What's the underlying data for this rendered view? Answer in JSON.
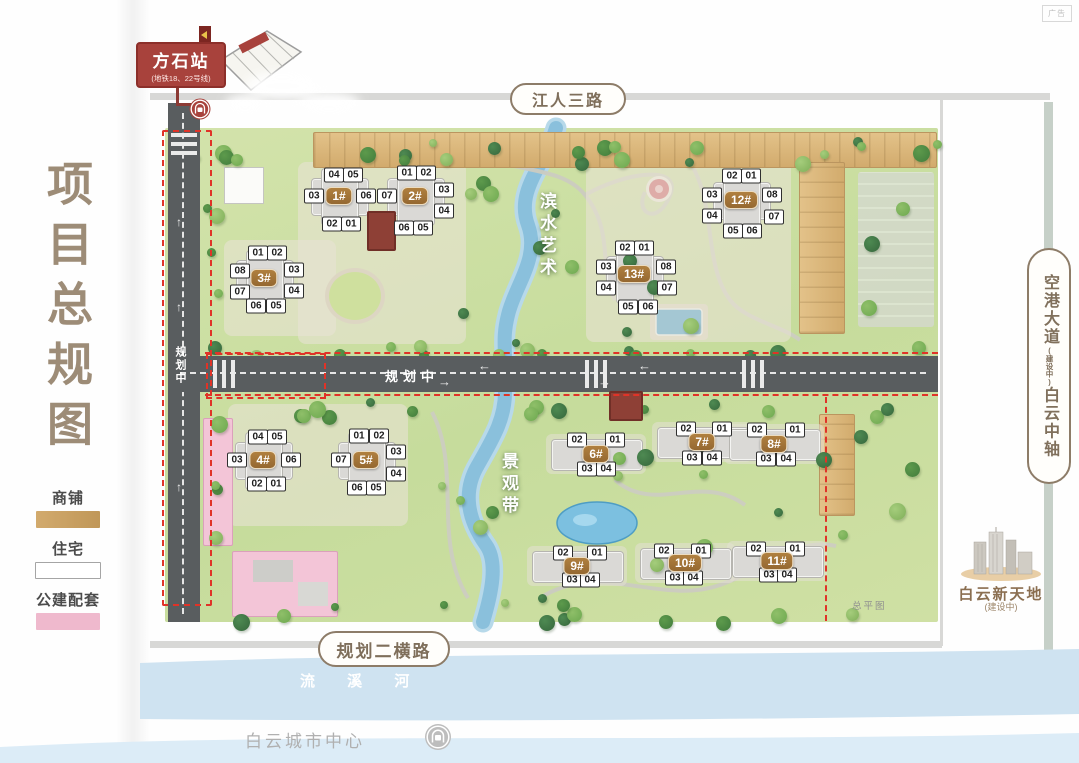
{
  "page": {
    "ad_badge": "广告",
    "plan_note": "总平图"
  },
  "title": {
    "text": "项目总规图"
  },
  "legend": [
    {
      "label": "商铺",
      "swatch": "#d2aa6d",
      "swatch2": "#c09758"
    },
    {
      "label": "住宅",
      "swatch": "#ffffff"
    },
    {
      "label": "公建配套",
      "swatch": "#efb9cd"
    }
  ],
  "station": {
    "name": "方石站",
    "lines": "(地铁18、22号线)"
  },
  "roads": {
    "top": "江人三路",
    "bottom": "规划二横路",
    "center": "规划中",
    "left": "规划中",
    "right_main": "空港大道",
    "right_sub": "(建设中)",
    "right_main2": "白云中轴",
    "arrows": {
      "left": "←",
      "right": "→",
      "up": "↑"
    }
  },
  "water": {
    "river": "流 溪 河",
    "stream_top": "滨水艺术",
    "stream_bottom": "景观带"
  },
  "landmarks": {
    "city_center": "白云城市中心",
    "new_world": "白云新天地",
    "new_world_sub": "(建设中)"
  },
  "clusters": [
    {
      "id": "1#",
      "x": 339,
      "y": 196,
      "shape": "tower",
      "units": [
        {
          "n": "04",
          "x": 334,
          "y": 175
        },
        {
          "n": "05",
          "x": 353,
          "y": 175
        },
        {
          "n": "03",
          "x": 314,
          "y": 196
        },
        {
          "n": "06",
          "x": 366,
          "y": 196
        },
        {
          "n": "07",
          "x": 387,
          "y": 196
        },
        {
          "n": "02",
          "x": 332,
          "y": 224
        },
        {
          "n": "01",
          "x": 351,
          "y": 224
        }
      ]
    },
    {
      "id": "2#",
      "x": 415,
      "y": 196,
      "shape": "tower",
      "units": [
        {
          "n": "01",
          "x": 407,
          "y": 173
        },
        {
          "n": "02",
          "x": 426,
          "y": 173
        },
        {
          "n": "03",
          "x": 444,
          "y": 190
        },
        {
          "n": "04",
          "x": 444,
          "y": 211
        },
        {
          "n": "06",
          "x": 404,
          "y": 228
        },
        {
          "n": "05",
          "x": 423,
          "y": 228
        }
      ]
    },
    {
      "id": "3#",
      "x": 264,
      "y": 278,
      "shape": "tower",
      "units": [
        {
          "n": "01",
          "x": 258,
          "y": 253
        },
        {
          "n": "02",
          "x": 277,
          "y": 253
        },
        {
          "n": "08",
          "x": 240,
          "y": 271
        },
        {
          "n": "07",
          "x": 240,
          "y": 292
        },
        {
          "n": "03",
          "x": 294,
          "y": 270
        },
        {
          "n": "04",
          "x": 294,
          "y": 291
        },
        {
          "n": "06",
          "x": 256,
          "y": 306
        },
        {
          "n": "05",
          "x": 276,
          "y": 306
        }
      ]
    },
    {
      "id": "13#",
      "x": 634,
      "y": 274,
      "shape": "tower",
      "units": [
        {
          "n": "02",
          "x": 625,
          "y": 248
        },
        {
          "n": "01",
          "x": 644,
          "y": 248
        },
        {
          "n": "03",
          "x": 606,
          "y": 267
        },
        {
          "n": "04",
          "x": 606,
          "y": 288
        },
        {
          "n": "08",
          "x": 666,
          "y": 267
        },
        {
          "n": "07",
          "x": 667,
          "y": 288
        },
        {
          "n": "05",
          "x": 628,
          "y": 307
        },
        {
          "n": "06",
          "x": 648,
          "y": 307
        }
      ]
    },
    {
      "id": "12#",
      "x": 741,
      "y": 200,
      "shape": "tower",
      "units": [
        {
          "n": "02",
          "x": 732,
          "y": 176
        },
        {
          "n": "01",
          "x": 751,
          "y": 176
        },
        {
          "n": "03",
          "x": 712,
          "y": 195
        },
        {
          "n": "04",
          "x": 712,
          "y": 216
        },
        {
          "n": "08",
          "x": 772,
          "y": 195
        },
        {
          "n": "07",
          "x": 774,
          "y": 217
        },
        {
          "n": "05",
          "x": 733,
          "y": 231
        },
        {
          "n": "06",
          "x": 752,
          "y": 231
        }
      ]
    },
    {
      "id": "4#",
      "x": 263,
      "y": 460,
      "shape": "tower",
      "units": [
        {
          "n": "04",
          "x": 258,
          "y": 437
        },
        {
          "n": "05",
          "x": 277,
          "y": 437
        },
        {
          "n": "03",
          "x": 237,
          "y": 460
        },
        {
          "n": "06",
          "x": 291,
          "y": 460
        },
        {
          "n": "02",
          "x": 257,
          "y": 484
        },
        {
          "n": "01",
          "x": 276,
          "y": 484
        }
      ]
    },
    {
      "id": "5#",
      "x": 366,
      "y": 460,
      "shape": "tower",
      "units": [
        {
          "n": "01",
          "x": 359,
          "y": 436
        },
        {
          "n": "02",
          "x": 379,
          "y": 436
        },
        {
          "n": "07",
          "x": 341,
          "y": 460
        },
        {
          "n": "03",
          "x": 396,
          "y": 452
        },
        {
          "n": "04",
          "x": 396,
          "y": 474
        },
        {
          "n": "06",
          "x": 357,
          "y": 488
        },
        {
          "n": "05",
          "x": 376,
          "y": 488
        }
      ]
    },
    {
      "id": "6#",
      "x": 596,
      "y": 454,
      "shape": "slab",
      "units": [
        {
          "n": "02",
          "x": 577,
          "y": 440
        },
        {
          "n": "01",
          "x": 615,
          "y": 440
        },
        {
          "n": "03",
          "x": 587,
          "y": 469
        },
        {
          "n": "04",
          "x": 606,
          "y": 469
        }
      ]
    },
    {
      "id": "7#",
      "x": 702,
      "y": 442,
      "shape": "slab",
      "units": [
        {
          "n": "02",
          "x": 686,
          "y": 429
        },
        {
          "n": "01",
          "x": 722,
          "y": 429
        },
        {
          "n": "03",
          "x": 692,
          "y": 458
        },
        {
          "n": "04",
          "x": 712,
          "y": 458
        }
      ]
    },
    {
      "id": "8#",
      "x": 774,
      "y": 444,
      "shape": "slab",
      "units": [
        {
          "n": "02",
          "x": 757,
          "y": 430
        },
        {
          "n": "01",
          "x": 795,
          "y": 430
        },
        {
          "n": "03",
          "x": 766,
          "y": 459
        },
        {
          "n": "04",
          "x": 786,
          "y": 459
        }
      ]
    },
    {
      "id": "9#",
      "x": 577,
      "y": 566,
      "shape": "slab",
      "units": [
        {
          "n": "02",
          "x": 563,
          "y": 553
        },
        {
          "n": "01",
          "x": 597,
          "y": 553
        },
        {
          "n": "03",
          "x": 572,
          "y": 580
        },
        {
          "n": "04",
          "x": 590,
          "y": 580
        }
      ]
    },
    {
      "id": "10#",
      "x": 685,
      "y": 563,
      "shape": "slab",
      "units": [
        {
          "n": "02",
          "x": 664,
          "y": 551
        },
        {
          "n": "01",
          "x": 701,
          "y": 551
        },
        {
          "n": "03",
          "x": 675,
          "y": 578
        },
        {
          "n": "04",
          "x": 693,
          "y": 578
        }
      ]
    },
    {
      "id": "11#",
      "x": 777,
      "y": 561,
      "shape": "slab",
      "units": [
        {
          "n": "02",
          "x": 756,
          "y": 549
        },
        {
          "n": "01",
          "x": 795,
          "y": 549
        },
        {
          "n": "03",
          "x": 769,
          "y": 575
        },
        {
          "n": "04",
          "x": 787,
          "y": 575
        }
      ]
    }
  ]
}
